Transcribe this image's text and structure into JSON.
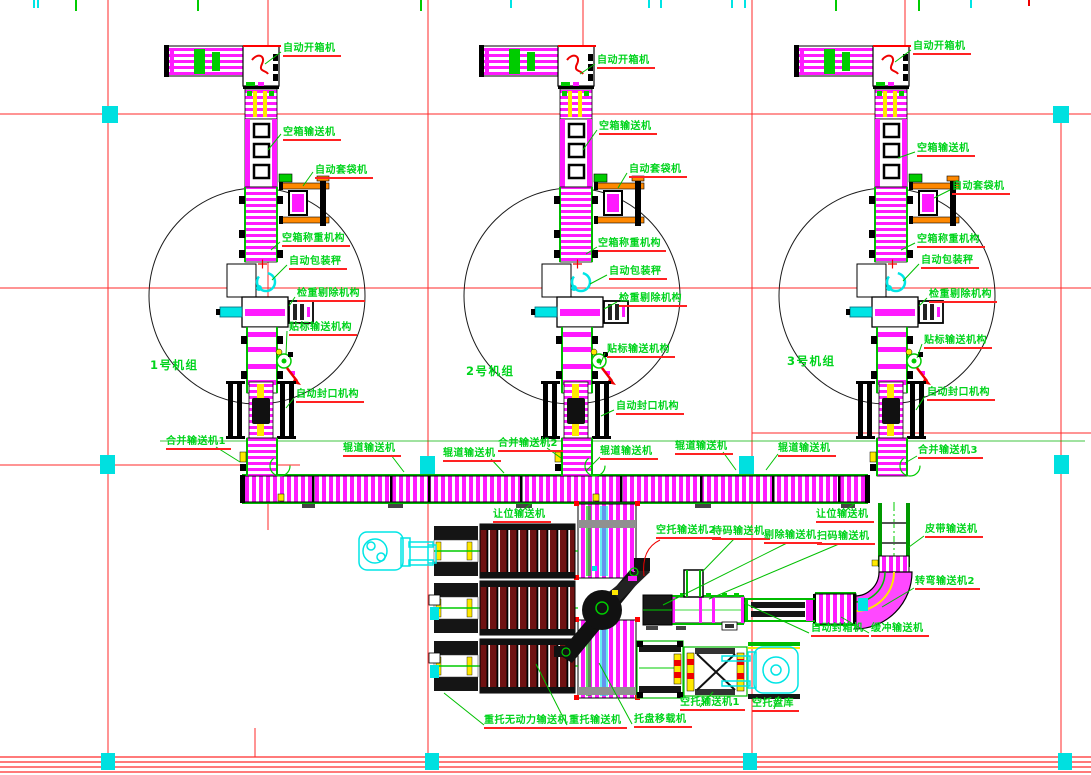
{
  "drawing": {
    "unit_groups": {
      "unit1": "1号机组",
      "unit2": "2号机组",
      "unit3": "3号机组"
    },
    "unit_equipment": {
      "carton_opener": "自动开箱机",
      "empty_carton_conveyor": "空箱输送机",
      "auto_bagging_machine": "自动套袋机",
      "carton_weighing_mechanism": "空箱称重机构",
      "auto_packing_scale": "自动包装秤",
      "checkweigher_reject_mechanism": "检重剔除机构",
      "labeling_conveyor_mechanism": "贴标输送机构",
      "auto_sealing_mechanism": "自动封口机构"
    },
    "main_line": {
      "merge_conveyor_1": "合并输送机1",
      "merge_conveyor_2": "合并输送机2",
      "merge_conveyor_3": "合并输送机3",
      "roller_conveyor": "辊道输送机",
      "yield_conveyor": "让位输送机"
    },
    "output_line": {
      "empty_pallet_conveyor_2": "空托输送机2",
      "waiting_conveyor": "待码输送机",
      "reject_conveyor": "剔除输送机",
      "scan_conveyor": "扫码输送机",
      "belt_conveyor": "皮带输送机",
      "curve_conveyor_2": "转弯输送机2",
      "auto_case_sealer": "自动封箱机",
      "buffer_conveyor": "缓冲输送机"
    },
    "pallet_area": {
      "heavy_pallet_unpowered_conveyor": "重托无动力输送机",
      "heavy_pallet_conveyor": "重托输送机",
      "pallet_transfer_machine": "托盘移载机",
      "empty_pallet_conveyor_1": "空托输送机1",
      "empty_pallet_store": "空托盘库"
    },
    "colors": {
      "label_green": "#00d41c",
      "underline_red": "#ff2222",
      "grid_red": "#ff2a2a",
      "machine_magenta": "#ff1aff",
      "marker_cyan": "#00e5e5",
      "pallet_dark_red": "#6e1212",
      "accent_yellow": "#ffe800",
      "accent_orange": "#ff8800"
    }
  }
}
